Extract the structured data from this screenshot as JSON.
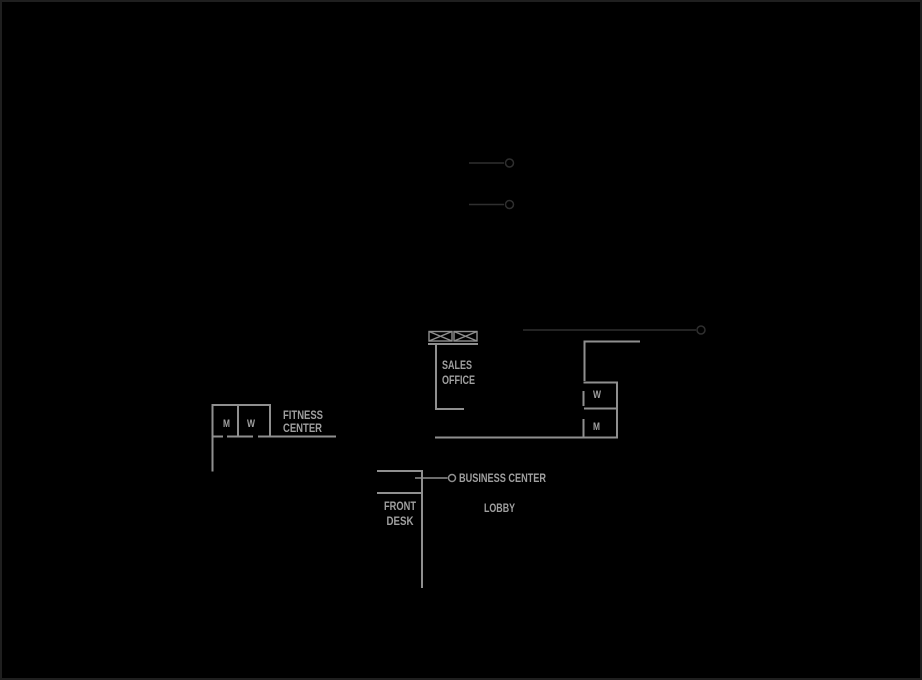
{
  "canvas": {
    "width": 922,
    "height": 680
  },
  "colors": {
    "background": "#000000",
    "frame_border": "#1f1f1f",
    "wall": "#8f8f8f",
    "label_text": "#a0a0a0",
    "callout_dark": "#2f2f2f",
    "callout_light": "#8f8f8f"
  },
  "floor_plan": {
    "labels": {
      "sales_office_line1": "SALES",
      "sales_office_line2": "OFFICE",
      "fitness_center_line1": "FITNESS",
      "fitness_center_line2": "CENTER",
      "business_center": "BUSINESS CENTER",
      "front_desk_line1": "FRONT",
      "front_desk_line2": "DESK",
      "lobby": "LOBBY",
      "fitness_restroom_men": "M",
      "fitness_restroom_women": "W",
      "lobby_restroom_women": "W",
      "lobby_restroom_men": "M"
    }
  }
}
